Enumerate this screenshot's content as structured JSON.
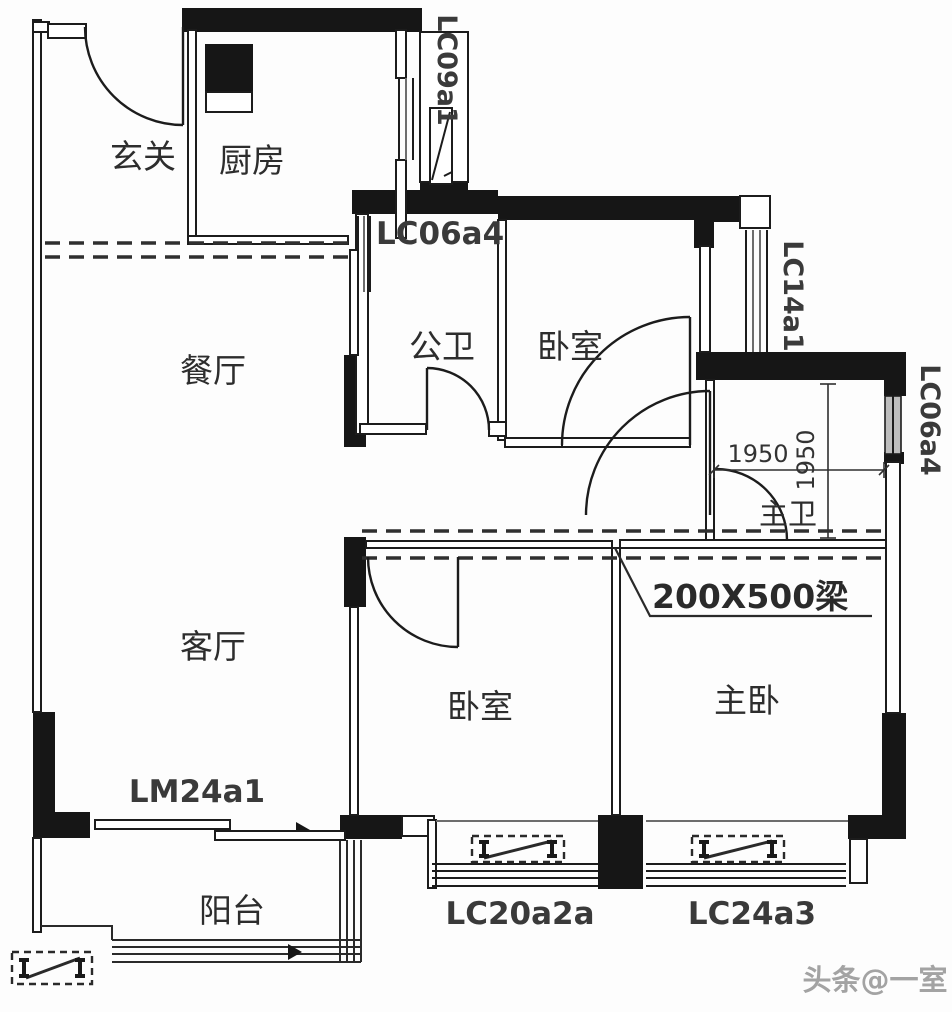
{
  "title": "apartment-floor-plan",
  "rooms": {
    "foyer": "玄关",
    "kitchen": "厨房",
    "dining": "餐厅",
    "living": "客厅",
    "balcony": "阳台",
    "bath_common": "公卫",
    "bedroom_top": "卧室",
    "bath_master": "主卫",
    "bedroom_mid": "卧室",
    "bedroom_master": "主卧"
  },
  "codes": {
    "kitchen_shaft_window": "LC09a1",
    "bath_common_window": "LC06a4",
    "bedroom_top_window": "LC14a1",
    "bath_master_window": "LC06a4",
    "balcony_sliding_door": "LM24a1",
    "bay_window_left": "LC20a2a",
    "bay_window_right": "LC24a3"
  },
  "dimensions": {
    "bath_master_width": "1950",
    "bath_master_depth": "1950",
    "beam_note": "200X500梁"
  },
  "watermark": {
    "text": "头条@一室"
  },
  "colors": {
    "wall": "#161616",
    "line": "#1c1c1c",
    "background": "#fdfdfd",
    "watermark": "#a3a3a3"
  }
}
